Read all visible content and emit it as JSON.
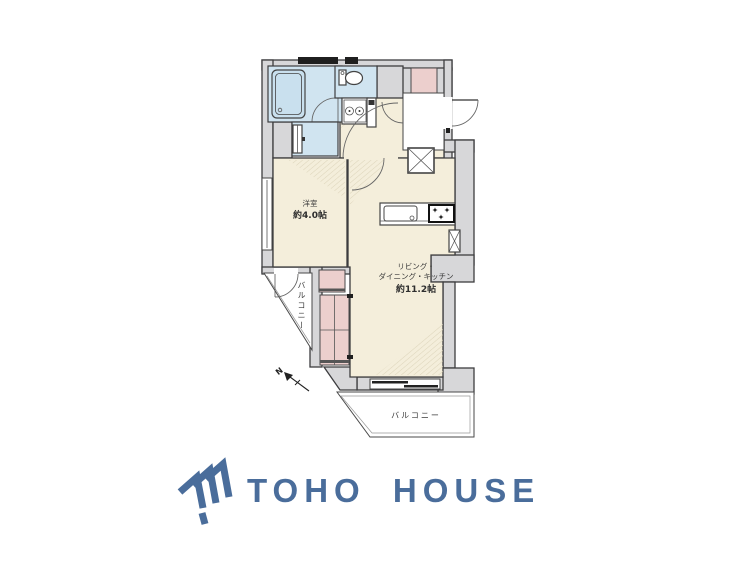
{
  "colors": {
    "wall_fill": "#d7d7d9",
    "room_fill": "#f4eedb",
    "wet_area_fill": "#d0e4f0",
    "closet_fill": "#eccfcd",
    "outline": "#3d3d3f",
    "logo_blue": "#4a6d9b"
  },
  "floorplan": {
    "western_room": {
      "name": "洋室",
      "size": "約4.0帖"
    },
    "ldk": {
      "name_line1": "リビング・",
      "name_line2": "ダイニング・キッチン",
      "size": "約11.2帖"
    },
    "balcony_side_label": "バルコニー",
    "balcony_bottom_label": "バルコニー",
    "compass_label": "N"
  },
  "logo": {
    "text": "TOHO HOUSE"
  }
}
